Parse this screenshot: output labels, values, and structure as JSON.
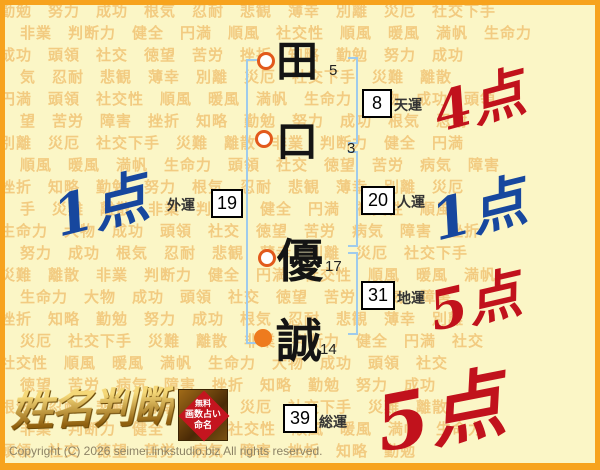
{
  "palette": {
    "frame": "#F7A31E",
    "bg": "#FBF6C6",
    "word": "#F1C475",
    "bracket": "#9FCBEC",
    "circle_orange": "#EE7B1E",
    "circle_ring": "#E2591B",
    "score_red": "#C1121C",
    "score_blue": "#17479E",
    "gold_light": "#F5D878",
    "gold_dark": "#8F5F0E",
    "seal_red": "#C4151F",
    "copy": "#8D8366"
  },
  "background": {
    "rows": [
      "勤勉　努力　成功　根気　忍耐　悲観　薄幸　別離　災厄　社交下手",
      "非業　判断力　健全　円満　順風　社交性　順風　暖風　満帆　生命力",
      "成功　頭領　社交　徳望　苦労　挫折　知略　勤勉　努力　成功",
      "気　忍耐　悲観　薄幸　別離　災厄　社交下手　災難　離散",
      "円満　頭領　社交性　順風　暖風　満帆　生命力　大物　成功　頭領",
      "望　苦労　障害　挫折　知略　勤勉　努力　成功　根気　忍耐",
      "別離　災厄　社交下手　災難　離散　非業　判断力　健全　円満",
      "順風　暖風　満帆　生命力　頭領　社交　徳望　苦労　病気　障害",
      "挫折　知略　勤勉　努力　根気　忍耐　悲観　薄幸　別離　災厄",
      "手　災難　離散　非業　判断力　健全　円満　社交性　順風",
      "生命力　大物　成功　頭領　社交　徳望　苦労　病気　障害　挫折",
      "努力　成功　根気　忍耐　悲観　薄幸　別離　災厄　社交下手",
      "災難　離散　非業　判断力　健全　円満　社交性　順風　暖風　満帆",
      "生命力　大物　成功　頭領　社交　徳望　苦労　病気　障害",
      "挫折　知略　勤勉　努力　成功　根気　忍耐　悲観　薄幸　別離",
      "災厄　社交下手　災難　離散　非業　判断力　健全　円満　社交",
      "社交性　順風　暖風　満帆　生命力　大物　成功　頭領　社交",
      "徳望　苦労　病気　障害　挫折　知略　勤勉　努力　成功",
      "根気　忍耐　悲観　薄幸　別離　災厄　社交下手　災難　離散",
      "非業　判断力　健全　円満　社交性　順風　暖風　満帆　生命力",
      "頭領　社交　徳望　苦労　病気　障害　挫折　知略　勤勉"
    ]
  },
  "name_chart": {
    "characters": [
      {
        "char": "田",
        "strokes": "5"
      },
      {
        "char": "口",
        "strokes": "3"
      },
      {
        "char": "優",
        "strokes": "17"
      },
      {
        "char": "誠",
        "strokes": "14"
      }
    ],
    "fortunes": {
      "tenun": {
        "value": "8",
        "label": "天運"
      },
      "gaiun": {
        "value": "19",
        "label": "外運"
      },
      "jinun": {
        "value": "20",
        "label": "人運"
      },
      "chiun": {
        "value": "31",
        "label": "地運"
      },
      "souun": {
        "value": "39",
        "label": "総運"
      }
    },
    "scores": {
      "tenun": "4点",
      "gaiun": "1点",
      "jinun": "1点",
      "chiun": "5点",
      "souun": "5点"
    }
  },
  "logo": {
    "title": "姓名判断",
    "seal_lines": [
      "無料",
      "画数占い",
      "命名"
    ]
  },
  "footer": {
    "copyright": "Copyright (C) 2026 seimei.linkstudio.biz All rights reserved."
  }
}
